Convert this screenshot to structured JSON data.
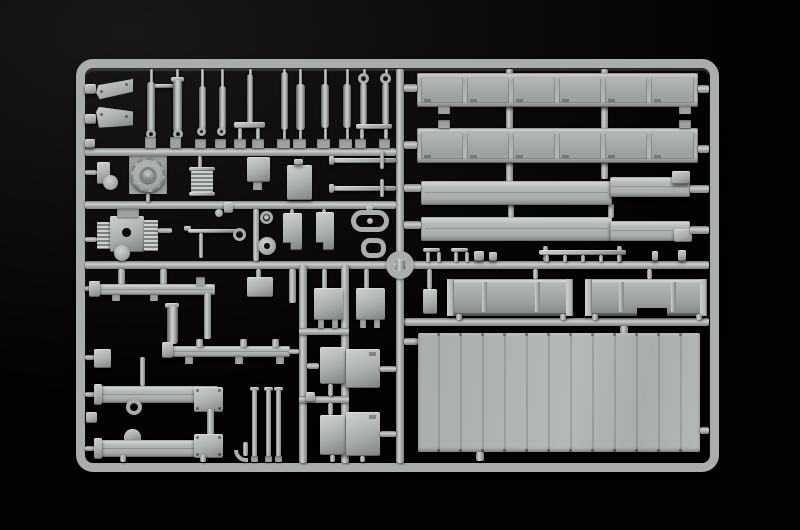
{
  "scene": {
    "description": "Light grey injection-moulded model kit parts sprue (truck/trailer components) photographed on a black background"
  },
  "palette": {
    "bg0": "#020202",
    "bg1": "#181818",
    "pBase": "#a9aeac",
    "pMid": "#b4b8b6",
    "pLight": "#cdd1cf",
    "pDark": "#7e8381",
    "pShadow": "#585d5b",
    "pIn": "#9da2a0",
    "holeC": "#070808"
  }
}
